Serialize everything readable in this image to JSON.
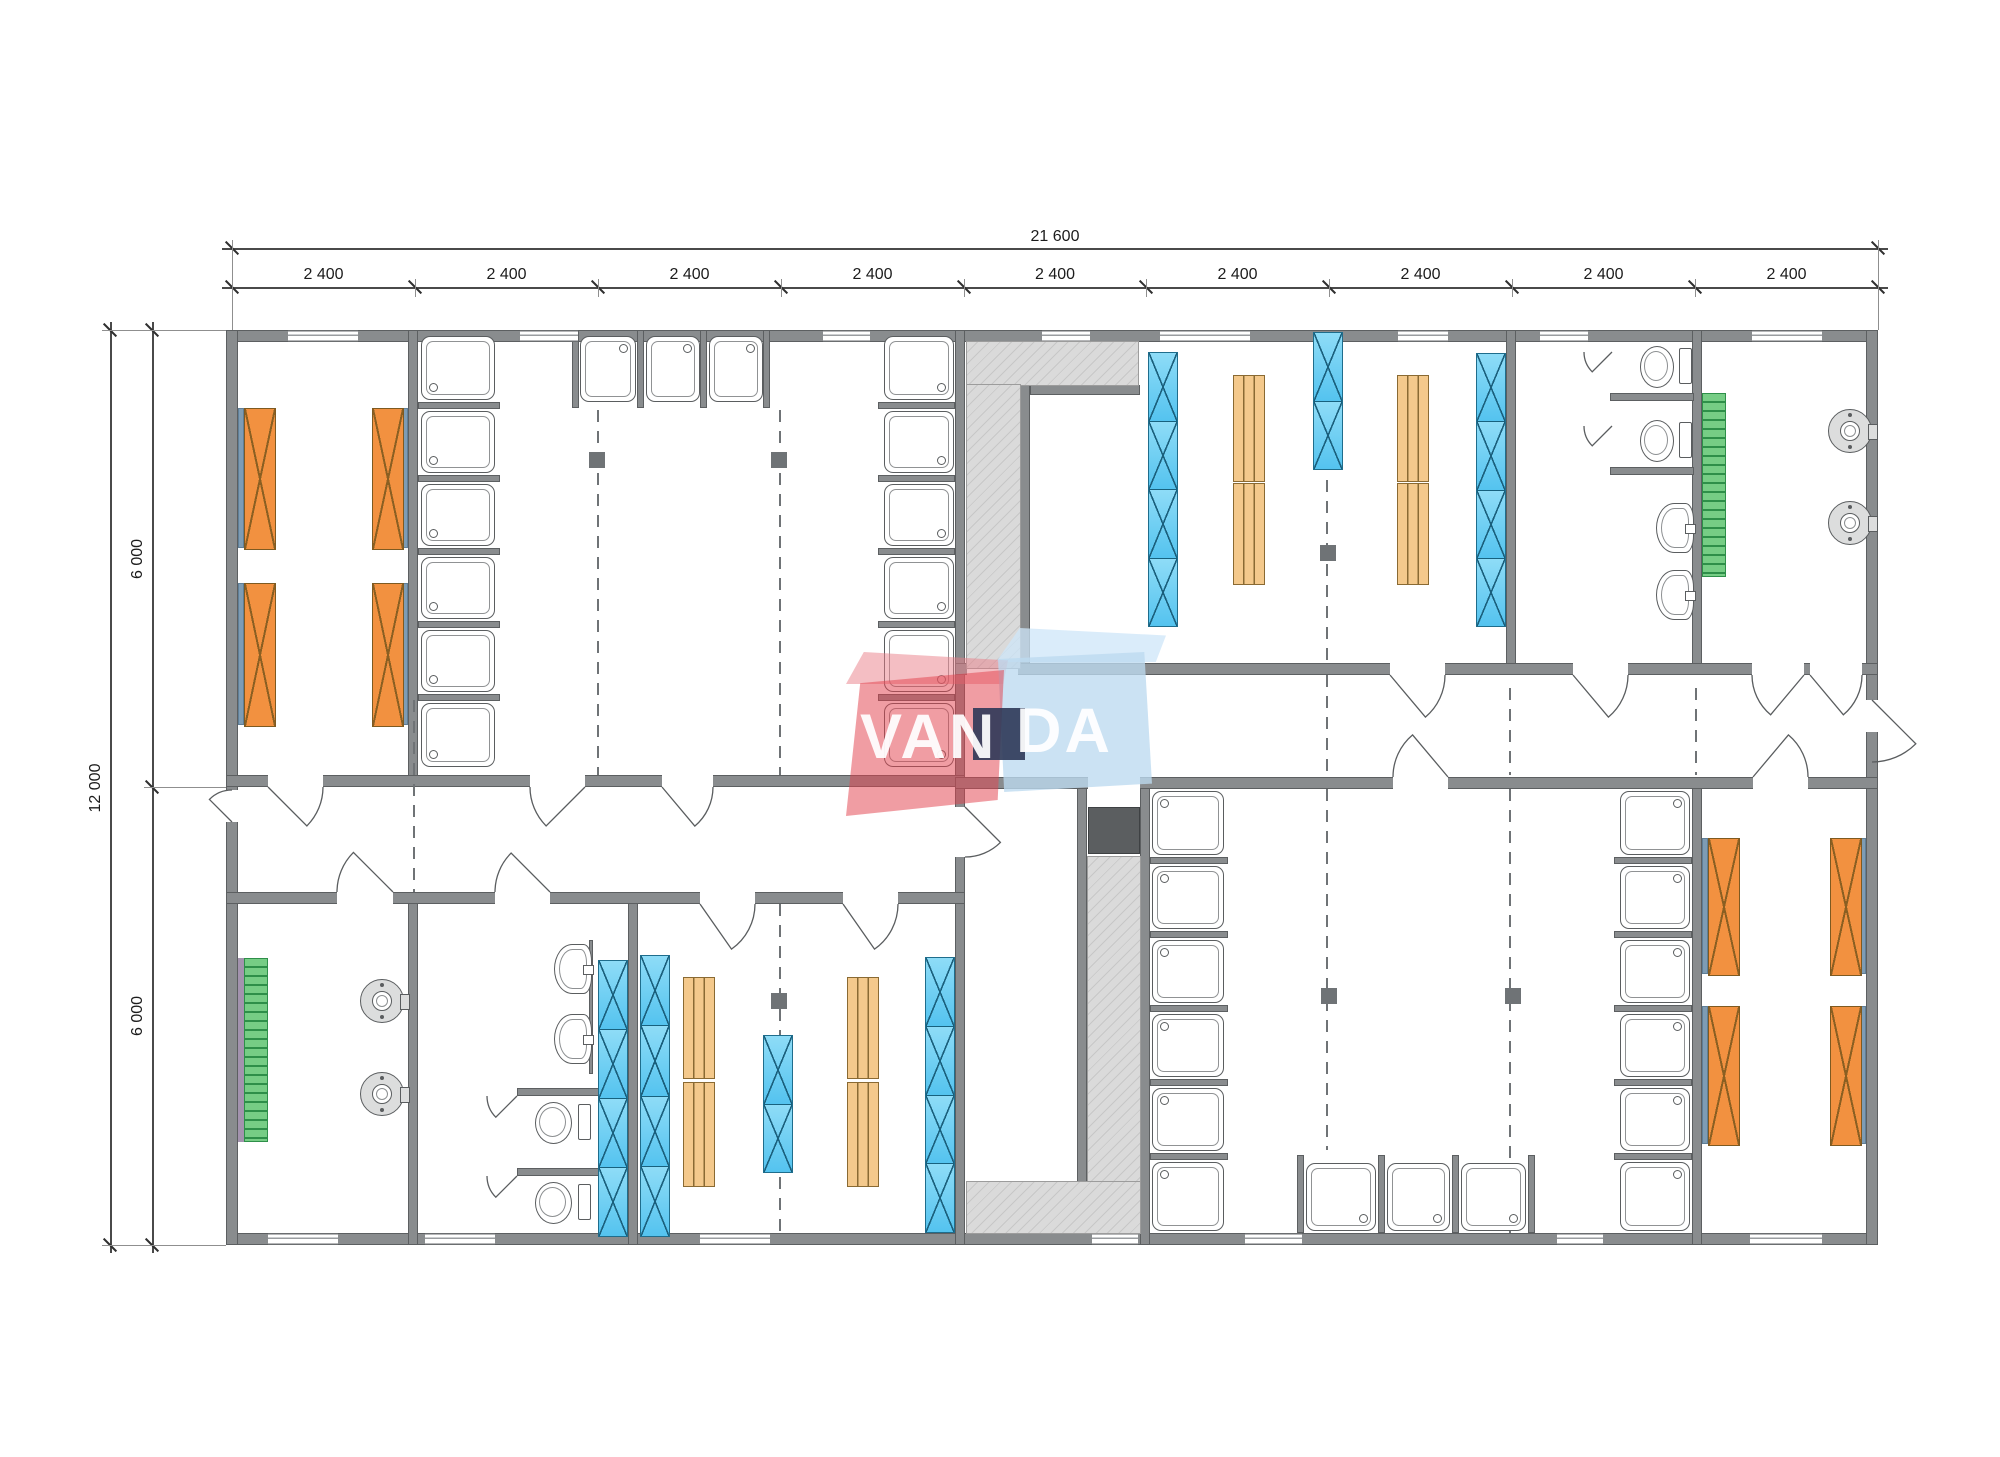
{
  "dimensions": {
    "top_total": "21 600",
    "top_segments": [
      "2 400",
      "2 400",
      "2 400",
      "2 400",
      "2 400",
      "2 400",
      "2 400",
      "2 400",
      "2 400"
    ],
    "left_total": "12 000",
    "left_segments": [
      "6 000",
      "6 000"
    ]
  },
  "logo": {
    "part1": "VAN",
    "part2": "DA"
  },
  "colors": {
    "wall": "#898c8e",
    "bed_orange": "#f29140",
    "locker_blue": "#5ec8f2",
    "bench_tan": "#f4c98c",
    "radiator_green": "#76cd85",
    "hatch_gray": "#d5d5d5",
    "logo_red": "#e2434f",
    "logo_blue": "#bddaf0",
    "logo_navy": "#2d3958"
  },
  "plan": {
    "walls": [
      [
        226,
        330,
        1652,
        12
      ],
      [
        226,
        1233,
        1652,
        12
      ],
      [
        226,
        330,
        12,
        915
      ],
      [
        1866,
        330,
        12,
        915
      ],
      [
        408,
        330,
        10,
        457
      ],
      [
        955,
        330,
        10,
        915
      ],
      [
        1020,
        385,
        10,
        283
      ],
      [
        1506,
        330,
        10,
        345
      ],
      [
        1692,
        330,
        10,
        345
      ],
      [
        408,
        893,
        10,
        352
      ],
      [
        628,
        893,
        10,
        352
      ],
      [
        1077,
        787,
        10,
        395
      ],
      [
        1140,
        777,
        10,
        468
      ],
      [
        1692,
        785,
        10,
        460
      ],
      [
        226,
        775,
        739,
        12
      ],
      [
        226,
        892,
        739,
        12
      ],
      [
        955,
        663,
        923,
        12
      ],
      [
        955,
        777,
        923,
        12
      ],
      [
        1030,
        385,
        110,
        10
      ],
      [
        1610,
        393,
        84,
        8
      ],
      [
        1610,
        467,
        84,
        8
      ],
      [
        517,
        1088,
        82,
        8
      ],
      [
        517,
        1168,
        82,
        8
      ],
      [
        589,
        940,
        4,
        134
      ],
      [
        418,
        402,
        82,
        7
      ],
      [
        418,
        475,
        82,
        7
      ],
      [
        418,
        548,
        82,
        7
      ],
      [
        418,
        621,
        82,
        7
      ],
      [
        418,
        694,
        82,
        7
      ],
      [
        572,
        330,
        7,
        78
      ],
      [
        637,
        330,
        7,
        78
      ],
      [
        700,
        330,
        7,
        78
      ],
      [
        763,
        330,
        7,
        78
      ],
      [
        878,
        402,
        77,
        7
      ],
      [
        878,
        475,
        77,
        7
      ],
      [
        878,
        548,
        77,
        7
      ],
      [
        878,
        621,
        77,
        7
      ],
      [
        878,
        694,
        77,
        7
      ],
      [
        1150,
        857,
        78,
        7
      ],
      [
        1150,
        931,
        78,
        7
      ],
      [
        1150,
        1005,
        78,
        7
      ],
      [
        1150,
        1079,
        78,
        7
      ],
      [
        1150,
        1153,
        78,
        7
      ],
      [
        1614,
        857,
        78,
        7
      ],
      [
        1614,
        931,
        78,
        7
      ],
      [
        1614,
        1005,
        78,
        7
      ],
      [
        1614,
        1079,
        78,
        7
      ],
      [
        1614,
        1153,
        78,
        7
      ],
      [
        1297,
        1155,
        7,
        78
      ],
      [
        1378,
        1155,
        7,
        78
      ],
      [
        1452,
        1155,
        7,
        78
      ],
      [
        1528,
        1155,
        7,
        78
      ]
    ],
    "gaps": [
      [
        268,
        775,
        55,
        12
      ],
      [
        530,
        775,
        55,
        12
      ],
      [
        662,
        775,
        51,
        12
      ],
      [
        337,
        892,
        56,
        12
      ],
      [
        495,
        892,
        55,
        12
      ],
      [
        700,
        892,
        55,
        12
      ],
      [
        843,
        892,
        55,
        12
      ],
      [
        967,
        663,
        51,
        12
      ],
      [
        1390,
        663,
        55,
        12
      ],
      [
        1573,
        663,
        55,
        12
      ],
      [
        1752,
        663,
        52,
        12
      ],
      [
        1810,
        663,
        52,
        12
      ],
      [
        1088,
        777,
        52,
        12
      ],
      [
        1393,
        777,
        55,
        12
      ],
      [
        1753,
        777,
        55,
        12
      ],
      [
        955,
        807,
        10,
        50
      ],
      [
        226,
        790,
        12,
        32
      ],
      [
        1866,
        700,
        12,
        32
      ]
    ],
    "windows": [
      [
        288,
        330,
        70,
        12
      ],
      [
        520,
        330,
        58,
        12
      ],
      [
        823,
        330,
        47,
        12
      ],
      [
        1042,
        330,
        48,
        12
      ],
      [
        1160,
        330,
        90,
        12
      ],
      [
        1398,
        330,
        50,
        12
      ],
      [
        1540,
        330,
        48,
        12
      ],
      [
        1752,
        330,
        70,
        12
      ],
      [
        268,
        1233,
        70,
        12
      ],
      [
        425,
        1233,
        70,
        12
      ],
      [
        700,
        1233,
        70,
        12
      ],
      [
        1092,
        1233,
        46,
        12
      ],
      [
        1245,
        1233,
        57,
        12
      ],
      [
        1557,
        1233,
        46,
        12
      ],
      [
        1750,
        1233,
        72,
        12
      ]
    ],
    "hatches": [
      [
        967,
        342,
        171,
        43
      ],
      [
        967,
        385,
        53,
        283
      ],
      [
        1088,
        857,
        52,
        325
      ],
      [
        967,
        1182,
        173,
        51
      ]
    ],
    "dashes": [
      [
        413,
        700,
        892
      ],
      [
        597,
        410,
        775
      ],
      [
        779,
        410,
        775
      ],
      [
        1326,
        480,
        663
      ],
      [
        1326,
        675,
        777
      ],
      [
        779,
        904,
        1233
      ],
      [
        1326,
        789,
        1150
      ],
      [
        1509,
        688,
        775
      ],
      [
        1509,
        789,
        1233
      ],
      [
        1695,
        688,
        775
      ]
    ],
    "columns": [
      [
        597,
        460
      ],
      [
        779,
        460
      ],
      [
        1328,
        553
      ],
      [
        779,
        1001
      ],
      [
        1329,
        996
      ],
      [
        1513,
        996
      ]
    ],
    "beds": [
      [
        244,
        408,
        30,
        140
      ],
      [
        244,
        583,
        30,
        142
      ],
      [
        372,
        408,
        30,
        140
      ],
      [
        372,
        583,
        30,
        142
      ],
      [
        1708,
        838,
        30,
        136
      ],
      [
        1708,
        1006,
        30,
        138
      ],
      [
        1830,
        838,
        30,
        136
      ],
      [
        1830,
        1006,
        30,
        138
      ]
    ],
    "bed_strips": [
      [
        238,
        408,
        6,
        140
      ],
      [
        238,
        583,
        6,
        142
      ],
      [
        402,
        408,
        6,
        140
      ],
      [
        402,
        583,
        6,
        142
      ],
      [
        1702,
        838,
        6,
        136
      ],
      [
        1702,
        1006,
        6,
        138
      ],
      [
        1860,
        838,
        6,
        136
      ],
      [
        1860,
        1006,
        6,
        138
      ]
    ],
    "lockers": [
      [
        1148,
        352,
        30,
        275,
        4
      ],
      [
        1313,
        332,
        30,
        138,
        2
      ],
      [
        1476,
        353,
        30,
        274,
        4
      ],
      [
        598,
        960,
        30,
        277,
        4
      ],
      [
        640,
        955,
        30,
        282,
        4
      ],
      [
        763,
        1035,
        30,
        138,
        2
      ],
      [
        925,
        957,
        30,
        276,
        4
      ]
    ],
    "benches": [
      [
        1233,
        375,
        30,
        105
      ],
      [
        1233,
        483,
        30,
        100
      ],
      [
        1397,
        375,
        30,
        105
      ],
      [
        1397,
        483,
        30,
        100
      ],
      [
        683,
        977,
        30,
        100
      ],
      [
        683,
        1082,
        30,
        103
      ],
      [
        847,
        977,
        30,
        100
      ],
      [
        847,
        1082,
        30,
        103
      ]
    ],
    "showers": [
      [
        421,
        336,
        72,
        62,
        "bl"
      ],
      [
        421,
        411,
        72,
        60,
        "bl"
      ],
      [
        421,
        484,
        72,
        60,
        "bl"
      ],
      [
        421,
        557,
        72,
        60,
        "bl"
      ],
      [
        421,
        630,
        72,
        60,
        "bl"
      ],
      [
        421,
        703,
        72,
        62,
        "bl"
      ],
      [
        580,
        336,
        54,
        64,
        "tr"
      ],
      [
        646,
        336,
        52,
        64,
        "tr"
      ],
      [
        709,
        336,
        52,
        64,
        "tr"
      ],
      [
        884,
        336,
        68,
        62,
        "br"
      ],
      [
        884,
        411,
        68,
        60,
        "br"
      ],
      [
        884,
        484,
        68,
        60,
        "br"
      ],
      [
        884,
        557,
        68,
        60,
        "br"
      ],
      [
        884,
        630,
        68,
        60,
        "br"
      ],
      [
        884,
        703,
        68,
        62,
        "br"
      ],
      [
        1152,
        791,
        70,
        62,
        "tl"
      ],
      [
        1152,
        866,
        70,
        61,
        "tl"
      ],
      [
        1152,
        940,
        70,
        61,
        "tl"
      ],
      [
        1152,
        1014,
        70,
        61,
        "tl"
      ],
      [
        1152,
        1088,
        70,
        61,
        "tl"
      ],
      [
        1152,
        1162,
        70,
        67,
        "tl"
      ],
      [
        1620,
        791,
        68,
        62,
        "tr"
      ],
      [
        1620,
        866,
        68,
        61,
        "tr"
      ],
      [
        1620,
        940,
        68,
        61,
        "tr"
      ],
      [
        1620,
        1014,
        68,
        61,
        "tr"
      ],
      [
        1620,
        1088,
        68,
        61,
        "tr"
      ],
      [
        1620,
        1162,
        68,
        67,
        "tr"
      ],
      [
        1306,
        1163,
        68,
        66,
        "br"
      ],
      [
        1387,
        1163,
        61,
        66,
        "br"
      ],
      [
        1461,
        1163,
        63,
        66,
        "br"
      ]
    ],
    "toilets": [
      [
        1640,
        346,
        52,
        40
      ],
      [
        1640,
        420,
        52,
        40
      ],
      [
        535,
        1102,
        56,
        40
      ],
      [
        535,
        1182,
        56,
        40
      ]
    ],
    "basins": [
      [
        1656,
        503,
        36,
        48
      ],
      [
        1656,
        570,
        36,
        48
      ],
      [
        554,
        944,
        36,
        48
      ],
      [
        554,
        1014,
        36,
        48
      ]
    ],
    "fountains": [
      [
        1849,
        430
      ],
      [
        1849,
        522
      ],
      [
        381,
        1000
      ],
      [
        381,
        1093
      ]
    ],
    "radiators": [
      [
        1702,
        393,
        24,
        184
      ],
      [
        244,
        958,
        24,
        184
      ]
    ],
    "pstrips": [
      [
        238,
        958,
        6,
        184
      ]
    ],
    "dark_squares": [
      [
        1088,
        807,
        50,
        45
      ]
    ],
    "doors": [
      [
        268,
        787,
        55,
        45,
        0
      ],
      [
        585,
        787,
        55,
        135,
        180
      ],
      [
        662,
        787,
        51,
        50,
        0
      ],
      [
        393,
        892,
        56,
        225,
        180
      ],
      [
        550,
        892,
        55,
        225,
        180
      ],
      [
        700,
        904,
        55,
        55,
        0
      ],
      [
        843,
        904,
        55,
        55,
        0
      ],
      [
        965,
        807,
        50,
        45,
        90
      ],
      [
        232,
        822,
        32,
        225,
        270
      ],
      [
        1872,
        700,
        62,
        45,
        90
      ],
      [
        1390,
        675,
        55,
        50,
        0
      ],
      [
        1573,
        675,
        55,
        50,
        0
      ],
      [
        1804,
        675,
        52,
        130,
        180
      ],
      [
        1810,
        675,
        52,
        50,
        0
      ],
      [
        1448,
        777,
        55,
        230,
        180
      ],
      [
        1753,
        777,
        55,
        310,
        360
      ],
      [
        1612,
        352,
        28,
        135,
        180
      ],
      [
        1612,
        426,
        28,
        135,
        180
      ],
      [
        517,
        1096,
        30,
        135,
        180
      ],
      [
        517,
        1176,
        30,
        135,
        180
      ]
    ],
    "dim": {
      "modules_x": [
        232,
        415,
        598,
        781,
        964,
        1146,
        1329,
        1512,
        1695,
        1878
      ],
      "top_line_y": 248,
      "top_seg_y": 287,
      "left_line_x": 110,
      "left_seg_x": 152,
      "levels_y": [
        330,
        787,
        1245
      ]
    }
  }
}
